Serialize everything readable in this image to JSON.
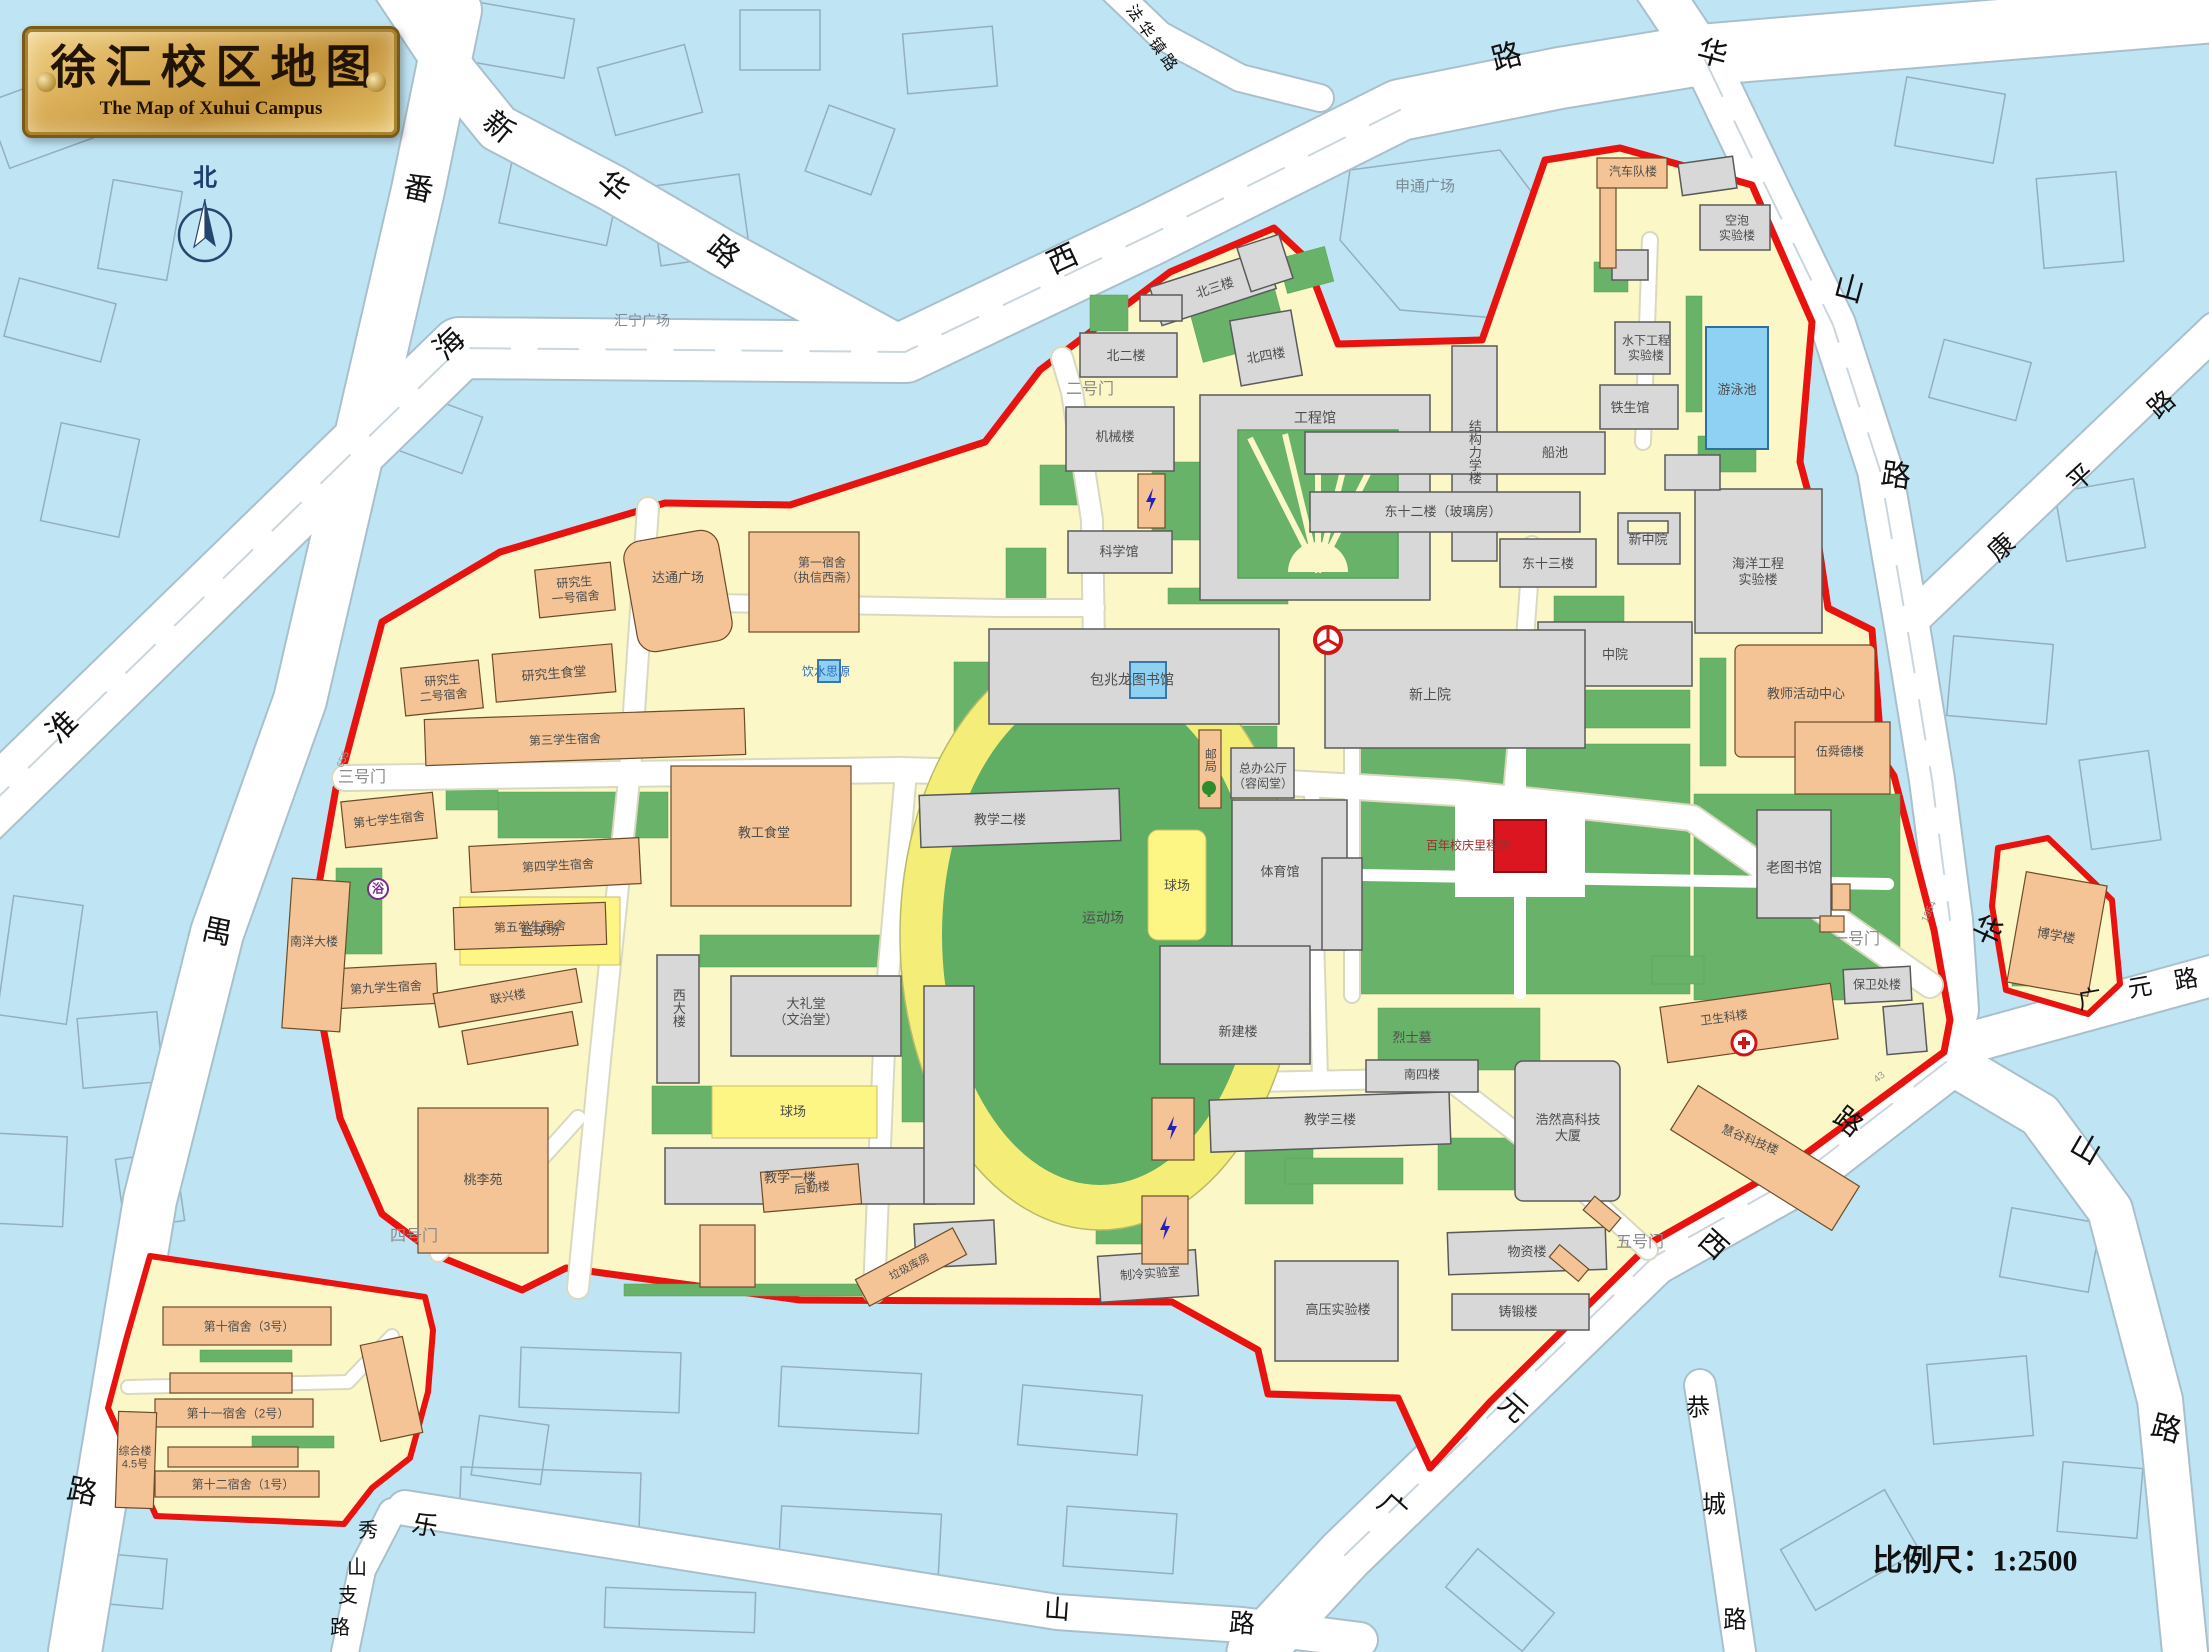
{
  "title": {
    "zh": "徐汇校区地图",
    "en": "The Map of Xuhui Campus"
  },
  "colors": {
    "water": "#bfe4f3",
    "campus_ground": "#fbf7c6",
    "boundary_red": "#e8120e",
    "green": "#68b269",
    "building_gray": "#d8d8d8",
    "building_orange": "#f4c496",
    "court_yellow": "#fdf584",
    "track_ring": "#f4ee79",
    "pool_blue": "#8ed1f2",
    "monument_red": "#dc1620",
    "road_white": "#ffffff"
  },
  "labels": [
    {
      "name": "compass-north-label",
      "text": "北",
      "x": 205,
      "y": 178,
      "size": 24,
      "color": "#1d3d6e",
      "weight": 700
    },
    {
      "name": "scale-label",
      "text": "比例尺：1:2500",
      "x": 1975,
      "y": 1562,
      "size": 30,
      "color": "#111111",
      "weight": 700,
      "serif": true
    },
    {
      "name": "road-panyu-char1",
      "text": "番",
      "x": 418,
      "y": 190,
      "size": 30,
      "color": "#111",
      "rot": 12
    },
    {
      "name": "road-panyu-char2",
      "text": "禺",
      "x": 217,
      "y": 933,
      "size": 30,
      "color": "#111",
      "rot": 12
    },
    {
      "name": "road-panyu-char3",
      "text": "路",
      "x": 82,
      "y": 1493,
      "size": 30,
      "color": "#111",
      "rot": 12
    },
    {
      "name": "road-xinhua-char1",
      "text": "新",
      "x": 498,
      "y": 128,
      "size": 30,
      "color": "#111",
      "rot": 40
    },
    {
      "name": "road-xinhua-char2",
      "text": "华",
      "x": 612,
      "y": 188,
      "size": 30,
      "color": "#111",
      "rot": 40
    },
    {
      "name": "road-xinhua-char3",
      "text": "路",
      "x": 723,
      "y": 253,
      "size": 30,
      "color": "#111",
      "rot": 40
    },
    {
      "name": "road-huaihaixi-char1",
      "text": "淮",
      "x": 63,
      "y": 728,
      "size": 30,
      "color": "#111",
      "rot": -44
    },
    {
      "name": "road-huaihaixi-char2",
      "text": "海",
      "x": 450,
      "y": 345,
      "size": 30,
      "color": "#111",
      "rot": -44
    },
    {
      "name": "road-huaihaixi-char3",
      "text": "西",
      "x": 1063,
      "y": 260,
      "size": 30,
      "color": "#111",
      "rot": -25
    },
    {
      "name": "road-huaihaixi-char4",
      "text": "路",
      "x": 1507,
      "y": 58,
      "size": 30,
      "color": "#111",
      "rot": -15
    },
    {
      "name": "road-fahuazhen",
      "text": "法华镇路",
      "x": 1152,
      "y": 40,
      "size": 16,
      "color": "#111",
      "rot": 55,
      "spacing": 4
    },
    {
      "name": "road-huashan-n-char1",
      "text": "华",
      "x": 1712,
      "y": 55,
      "size": 30,
      "color": "#111",
      "rot": 15
    },
    {
      "name": "road-huashan-n-char2",
      "text": "山",
      "x": 1849,
      "y": 290,
      "size": 30,
      "color": "#111",
      "rot": 15
    },
    {
      "name": "road-huashan-n-char3",
      "text": "路",
      "x": 1896,
      "y": 477,
      "size": 30,
      "color": "#111",
      "rot": 8
    },
    {
      "name": "road-huashan-s-char1",
      "text": "华",
      "x": 1987,
      "y": 932,
      "size": 30,
      "color": "#111",
      "rot": 25
    },
    {
      "name": "road-huashan-s-char2",
      "text": "山",
      "x": 2085,
      "y": 1150,
      "size": 30,
      "color": "#111",
      "rot": 30
    },
    {
      "name": "road-huashan-s-char3",
      "text": "路",
      "x": 2166,
      "y": 1430,
      "size": 30,
      "color": "#111",
      "rot": 15
    },
    {
      "name": "road-kangping-char1",
      "text": "康",
      "x": 2002,
      "y": 548,
      "size": 26,
      "color": "#111",
      "rot": -42
    },
    {
      "name": "road-kangping-char2",
      "text": "平",
      "x": 2081,
      "y": 478,
      "size": 26,
      "color": "#111",
      "rot": -42
    },
    {
      "name": "road-kangping-char3",
      "text": "路",
      "x": 2162,
      "y": 405,
      "size": 26,
      "color": "#111",
      "rot": -42
    },
    {
      "name": "road-guangyuan-char1",
      "text": "广",
      "x": 2090,
      "y": 1000,
      "size": 24,
      "color": "#111",
      "rot": -10
    },
    {
      "name": "road-guangyuan-char2",
      "text": "元",
      "x": 2140,
      "y": 988,
      "size": 24,
      "color": "#111",
      "rot": -10
    },
    {
      "name": "road-guangyuan-char3",
      "text": "路",
      "x": 2186,
      "y": 980,
      "size": 24,
      "color": "#111",
      "rot": -10
    },
    {
      "name": "road-guangyuanxi-char1",
      "text": "广",
      "x": 1392,
      "y": 1508,
      "size": 28,
      "color": "#111",
      "rot": 42
    },
    {
      "name": "road-guangyuanxi-char2",
      "text": "元",
      "x": 1513,
      "y": 1408,
      "size": 28,
      "color": "#111",
      "rot": 42
    },
    {
      "name": "road-guangyuanxi-char3",
      "text": "西",
      "x": 1713,
      "y": 1245,
      "size": 28,
      "color": "#111",
      "rot": 42
    },
    {
      "name": "road-guangyuanxi-char4",
      "text": "路",
      "x": 1848,
      "y": 1122,
      "size": 28,
      "color": "#111",
      "rot": 38
    },
    {
      "name": "road-gongcheng-char1",
      "text": "恭",
      "x": 1698,
      "y": 1408,
      "size": 24,
      "color": "#111"
    },
    {
      "name": "road-gongcheng-char2",
      "text": "城",
      "x": 1714,
      "y": 1505,
      "size": 24,
      "color": "#111"
    },
    {
      "name": "road-gongcheng-char3",
      "text": "路",
      "x": 1735,
      "y": 1620,
      "size": 24,
      "color": "#111"
    },
    {
      "name": "road-leshan-char1",
      "text": "乐",
      "x": 425,
      "y": 1526,
      "size": 26,
      "color": "#111",
      "rot": 10
    },
    {
      "name": "road-leshan-char2",
      "text": "山",
      "x": 1057,
      "y": 1610,
      "size": 26,
      "color": "#111",
      "rot": 4
    },
    {
      "name": "road-leshan-char3",
      "text": "路",
      "x": 1242,
      "y": 1624,
      "size": 26,
      "color": "#111",
      "rot": 4
    },
    {
      "name": "road-xiushan-char1",
      "text": "秀",
      "x": 368,
      "y": 1531,
      "size": 20,
      "color": "#111"
    },
    {
      "name": "road-xiushan-char2",
      "text": "山",
      "x": 357,
      "y": 1568,
      "size": 20,
      "color": "#111"
    },
    {
      "name": "road-xiushan-char3",
      "text": "支",
      "x": 348,
      "y": 1596,
      "size": 20,
      "color": "#111"
    },
    {
      "name": "road-xiushan-char4",
      "text": "路",
      "x": 340,
      "y": 1628,
      "size": 20,
      "color": "#111"
    },
    {
      "name": "gate-1-label",
      "text": "一号门",
      "x": 1856,
      "y": 940,
      "size": 16,
      "color": "#8a8a8a"
    },
    {
      "name": "gate-2-label",
      "text": "二号门",
      "x": 1090,
      "y": 390,
      "size": 16,
      "color": "#8a8a8a"
    },
    {
      "name": "gate-3-label",
      "text": "三号门",
      "x": 362,
      "y": 778,
      "size": 16,
      "color": "#8a8a8a"
    },
    {
      "name": "gate-4-label",
      "text": "四号门",
      "x": 414,
      "y": 1237,
      "size": 16,
      "color": "#8a8a8a"
    },
    {
      "name": "gate-5-label",
      "text": "五号门",
      "x": 1640,
      "y": 1243,
      "size": 16,
      "color": "#8a8a8a"
    },
    {
      "name": "gate-3-number",
      "text": "655",
      "x": 344,
      "y": 760,
      "size": 10,
      "color": "#999",
      "rot": -65
    },
    {
      "name": "gate-1-number",
      "text": "1954",
      "x": 1930,
      "y": 912,
      "size": 10,
      "color": "#999",
      "rot": -65
    },
    {
      "name": "gate-5-number",
      "text": "43",
      "x": 1880,
      "y": 1078,
      "size": 10,
      "color": "#999",
      "rot": -40
    },
    {
      "name": "plaza-shentong",
      "text": "申通广场",
      "x": 1425,
      "y": 187,
      "size": 15,
      "color": "#7a8a94"
    },
    {
      "name": "plaza-huining",
      "text": "汇宁广场",
      "x": 642,
      "y": 321,
      "size": 14,
      "color": "#7a8a94"
    },
    {
      "name": "martyrs-tomb-label",
      "text": "烈士墓",
      "x": 1412,
      "y": 1038,
      "size": 13,
      "color": "#4d4d4d"
    },
    {
      "name": "centennial-monument-label",
      "text": "百年校庆里程碑",
      "x": 1468,
      "y": 846,
      "size": 12,
      "color": "#a02c2c"
    },
    {
      "name": "bldg-beierlou",
      "text": "北二楼",
      "x": 1126,
      "y": 356,
      "size": 13
    },
    {
      "name": "bldg-beisanlou",
      "text": "北三楼",
      "x": 1215,
      "y": 288,
      "size": 13,
      "rot": -18
    },
    {
      "name": "bldg-beisilou",
      "text": "北四楼",
      "x": 1266,
      "y": 356,
      "size": 13,
      "rot": -10
    },
    {
      "name": "bldg-jixielou",
      "text": "机械楼",
      "x": 1115,
      "y": 437,
      "size": 13
    },
    {
      "name": "bldg-gongchengguan",
      "text": "工程馆",
      "x": 1315,
      "y": 418,
      "size": 14
    },
    {
      "name": "bldg-kexueguan",
      "text": "科学馆",
      "x": 1119,
      "y": 552,
      "size": 13
    },
    {
      "name": "bldg-jiegoulixuelou",
      "text": "结构力学楼",
      "x": 1474,
      "y": 452,
      "size": 13,
      "vertical": true
    },
    {
      "name": "bldg-chuanchi",
      "text": "船池",
      "x": 1555,
      "y": 453,
      "size": 13
    },
    {
      "name": "bldg-dong12lou",
      "text": "东十二楼（玻璃房）",
      "x": 1443,
      "y": 512,
      "size": 13
    },
    {
      "name": "bldg-dong13lou",
      "text": "东十三楼",
      "x": 1548,
      "y": 564,
      "size": 13
    },
    {
      "name": "bldg-xinzhongyuan",
      "text": "新中院",
      "x": 1648,
      "y": 540,
      "size": 13
    },
    {
      "name": "bldg-zhongyuan",
      "text": "中院",
      "x": 1615,
      "y": 655,
      "size": 13
    },
    {
      "name": "bldg-haiyanggongcheng",
      "text": "海洋工程\n实验楼",
      "x": 1758,
      "y": 572,
      "size": 13
    },
    {
      "name": "bldg-xinshangyuan",
      "text": "新上院",
      "x": 1430,
      "y": 695,
      "size": 14
    },
    {
      "name": "bldg-baozhaolong-library",
      "text": "包兆龙图书馆",
      "x": 1132,
      "y": 680,
      "size": 14
    },
    {
      "name": "bldg-jiaoxue2",
      "text": "教学二楼",
      "x": 1000,
      "y": 820,
      "size": 13
    },
    {
      "name": "bldg-tiyuguan",
      "text": "体育馆",
      "x": 1280,
      "y": 872,
      "size": 13
    },
    {
      "name": "bldg-zongbangongting",
      "text": "总办公厅\n（容闳堂）",
      "x": 1263,
      "y": 776,
      "size": 12
    },
    {
      "name": "bldg-youju",
      "text": "邮局",
      "x": 1210,
      "y": 760,
      "size": 12,
      "vertical": true
    },
    {
      "name": "bldg-xinjianlou",
      "text": "新建楼",
      "x": 1238,
      "y": 1032,
      "size": 13
    },
    {
      "name": "bldg-dalitang",
      "text": "大礼堂\n（文治堂）",
      "x": 806,
      "y": 1012,
      "size": 13
    },
    {
      "name": "bldg-xidalou",
      "text": "西大楼",
      "x": 678,
      "y": 1008,
      "size": 13,
      "vertical": true
    },
    {
      "name": "bldg-jiaoxue1",
      "text": "教学一楼",
      "x": 790,
      "y": 1178,
      "size": 13
    },
    {
      "name": "bldg-jiaoxue3",
      "text": "教学三楼",
      "x": 1330,
      "y": 1120,
      "size": 13
    },
    {
      "name": "bldg-nansilou",
      "text": "南四楼",
      "x": 1422,
      "y": 1075,
      "size": 12
    },
    {
      "name": "bldg-zhileng",
      "text": "制冷实验室",
      "x": 1150,
      "y": 1274,
      "size": 12,
      "rot": -4
    },
    {
      "name": "bldg-gaoya",
      "text": "高压实验楼",
      "x": 1338,
      "y": 1310,
      "size": 13
    },
    {
      "name": "bldg-wuzilou",
      "text": "物资楼",
      "x": 1527,
      "y": 1252,
      "size": 13
    },
    {
      "name": "bldg-zhuduanlou",
      "text": "铸锻楼",
      "x": 1518,
      "y": 1312,
      "size": 13
    },
    {
      "name": "bldg-laotushuguan",
      "text": "老图书馆",
      "x": 1794,
      "y": 868,
      "size": 14
    },
    {
      "name": "bldg-baoweichulou",
      "text": "保卫处楼",
      "x": 1877,
      "y": 985,
      "size": 12
    },
    {
      "name": "bldg-kongpao",
      "text": "空泡\n实验楼",
      "x": 1737,
      "y": 228,
      "size": 12
    },
    {
      "name": "bldg-shuixia",
      "text": "水下工程\n实验楼",
      "x": 1646,
      "y": 348,
      "size": 12
    },
    {
      "name": "bldg-tieshengguan",
      "text": "铁生馆",
      "x": 1630,
      "y": 408,
      "size": 13
    },
    {
      "name": "pool-label",
      "text": "游泳池",
      "x": 1737,
      "y": 390,
      "size": 13
    },
    {
      "name": "track-label",
      "text": "运动场",
      "x": 1103,
      "y": 918,
      "size": 14
    },
    {
      "name": "court-label-1",
      "text": "球场",
      "x": 1177,
      "y": 886,
      "size": 13
    },
    {
      "name": "court-label-2",
      "text": "球场",
      "x": 793,
      "y": 1112,
      "size": 13
    },
    {
      "name": "basketball-label",
      "text": "篮球场",
      "x": 540,
      "y": 931,
      "size": 13
    },
    {
      "name": "bldg-haoran",
      "text": "浩然高科技\n大厦",
      "x": 1568,
      "y": 1128,
      "size": 13
    },
    {
      "name": "bldg-boxuelou",
      "text": "博学楼",
      "x": 2056,
      "y": 936,
      "size": 13,
      "rot": 10
    },
    {
      "name": "bldg-qichedui",
      "text": "汽车队楼",
      "x": 1633,
      "y": 172,
      "size": 12
    },
    {
      "name": "bldg-yjs1",
      "text": "研究生\n一号宿舍",
      "x": 575,
      "y": 590,
      "size": 12,
      "rot": -5
    },
    {
      "name": "bldg-yjs2",
      "text": "研究生\n二号宿舍",
      "x": 443,
      "y": 688,
      "size": 12,
      "rot": -5
    },
    {
      "name": "bldg-yjs-canteen",
      "text": "研究生食堂",
      "x": 554,
      "y": 674,
      "size": 13,
      "rot": -5
    },
    {
      "name": "plaza-datong",
      "text": "达通广场",
      "x": 678,
      "y": 578,
      "size": 13
    },
    {
      "name": "bldg-dorm1",
      "text": "第一宿舍\n（执信西斋）",
      "x": 822,
      "y": 570,
      "size": 12
    },
    {
      "name": "monument-yinshuisiyuan-label",
      "text": "饮水思源",
      "x": 826,
      "y": 672,
      "size": 12,
      "color": "#2e6cb8"
    },
    {
      "name": "bldg-dorm3",
      "text": "第三学生宿舍",
      "x": 565,
      "y": 740,
      "size": 12,
      "rot": -2
    },
    {
      "name": "bldg-dorm7",
      "text": "第七学生宿舍",
      "x": 389,
      "y": 820,
      "size": 12,
      "rot": -6
    },
    {
      "name": "bldg-dorm4",
      "text": "第四学生宿舍",
      "x": 558,
      "y": 866,
      "size": 12,
      "rot": -3
    },
    {
      "name": "bldg-dorm5",
      "text": "第五学生宿舍",
      "x": 530,
      "y": 927,
      "size": 12,
      "rot": -2
    },
    {
      "name": "bldg-dorm9",
      "text": "第九学生宿舍",
      "x": 386,
      "y": 988,
      "size": 12,
      "rot": -3
    },
    {
      "name": "bldg-nanyangdalou",
      "text": "南洋大楼",
      "x": 314,
      "y": 942,
      "size": 12
    },
    {
      "name": "bldg-lianxinglou",
      "text": "联兴楼",
      "x": 508,
      "y": 997,
      "size": 12,
      "rot": -10
    },
    {
      "name": "bldg-taoliyuan",
      "text": "桃李苑",
      "x": 483,
      "y": 1180,
      "size": 13
    },
    {
      "name": "bldg-jiaogongshitang",
      "text": "教工食堂",
      "x": 764,
      "y": 833,
      "size": 13
    },
    {
      "name": "bldg-houqinlou",
      "text": "后勤楼",
      "x": 812,
      "y": 1188,
      "size": 12,
      "rot": -5
    },
    {
      "name": "bldg-lajikufang",
      "text": "垃圾库房",
      "x": 910,
      "y": 1268,
      "size": 11,
      "rot": -28
    },
    {
      "name": "bldg-jiaoshi-center",
      "text": "教师活动中心",
      "x": 1806,
      "y": 694,
      "size": 13
    },
    {
      "name": "bldg-wushundelou",
      "text": "伍舜德楼",
      "x": 1840,
      "y": 752,
      "size": 12
    },
    {
      "name": "bldg-weishengkelou",
      "text": "卫生科楼",
      "x": 1724,
      "y": 1018,
      "size": 12,
      "rot": -8
    },
    {
      "name": "bldg-huigu",
      "text": "慧谷科技楼",
      "x": 1750,
      "y": 1140,
      "size": 12,
      "rot": 22
    },
    {
      "name": "bldg-dorm10",
      "text": "第十宿舍（3号）",
      "x": 249,
      "y": 1327,
      "size": 12
    },
    {
      "name": "bldg-dorm11",
      "text": "第十一宿舍（2号）",
      "x": 238,
      "y": 1414,
      "size": 12
    },
    {
      "name": "bldg-dorm12",
      "text": "第十二宿舍（1号）",
      "x": 243,
      "y": 1485,
      "size": 12
    },
    {
      "name": "bldg-zonghelou",
      "text": "综合楼\n4.5号",
      "x": 135,
      "y": 1459,
      "size": 11
    },
    {
      "name": "bath-label",
      "text": "浴",
      "x": 378,
      "y": 889,
      "size": 12,
      "color": "#7b2d8b",
      "weight": 700
    }
  ]
}
